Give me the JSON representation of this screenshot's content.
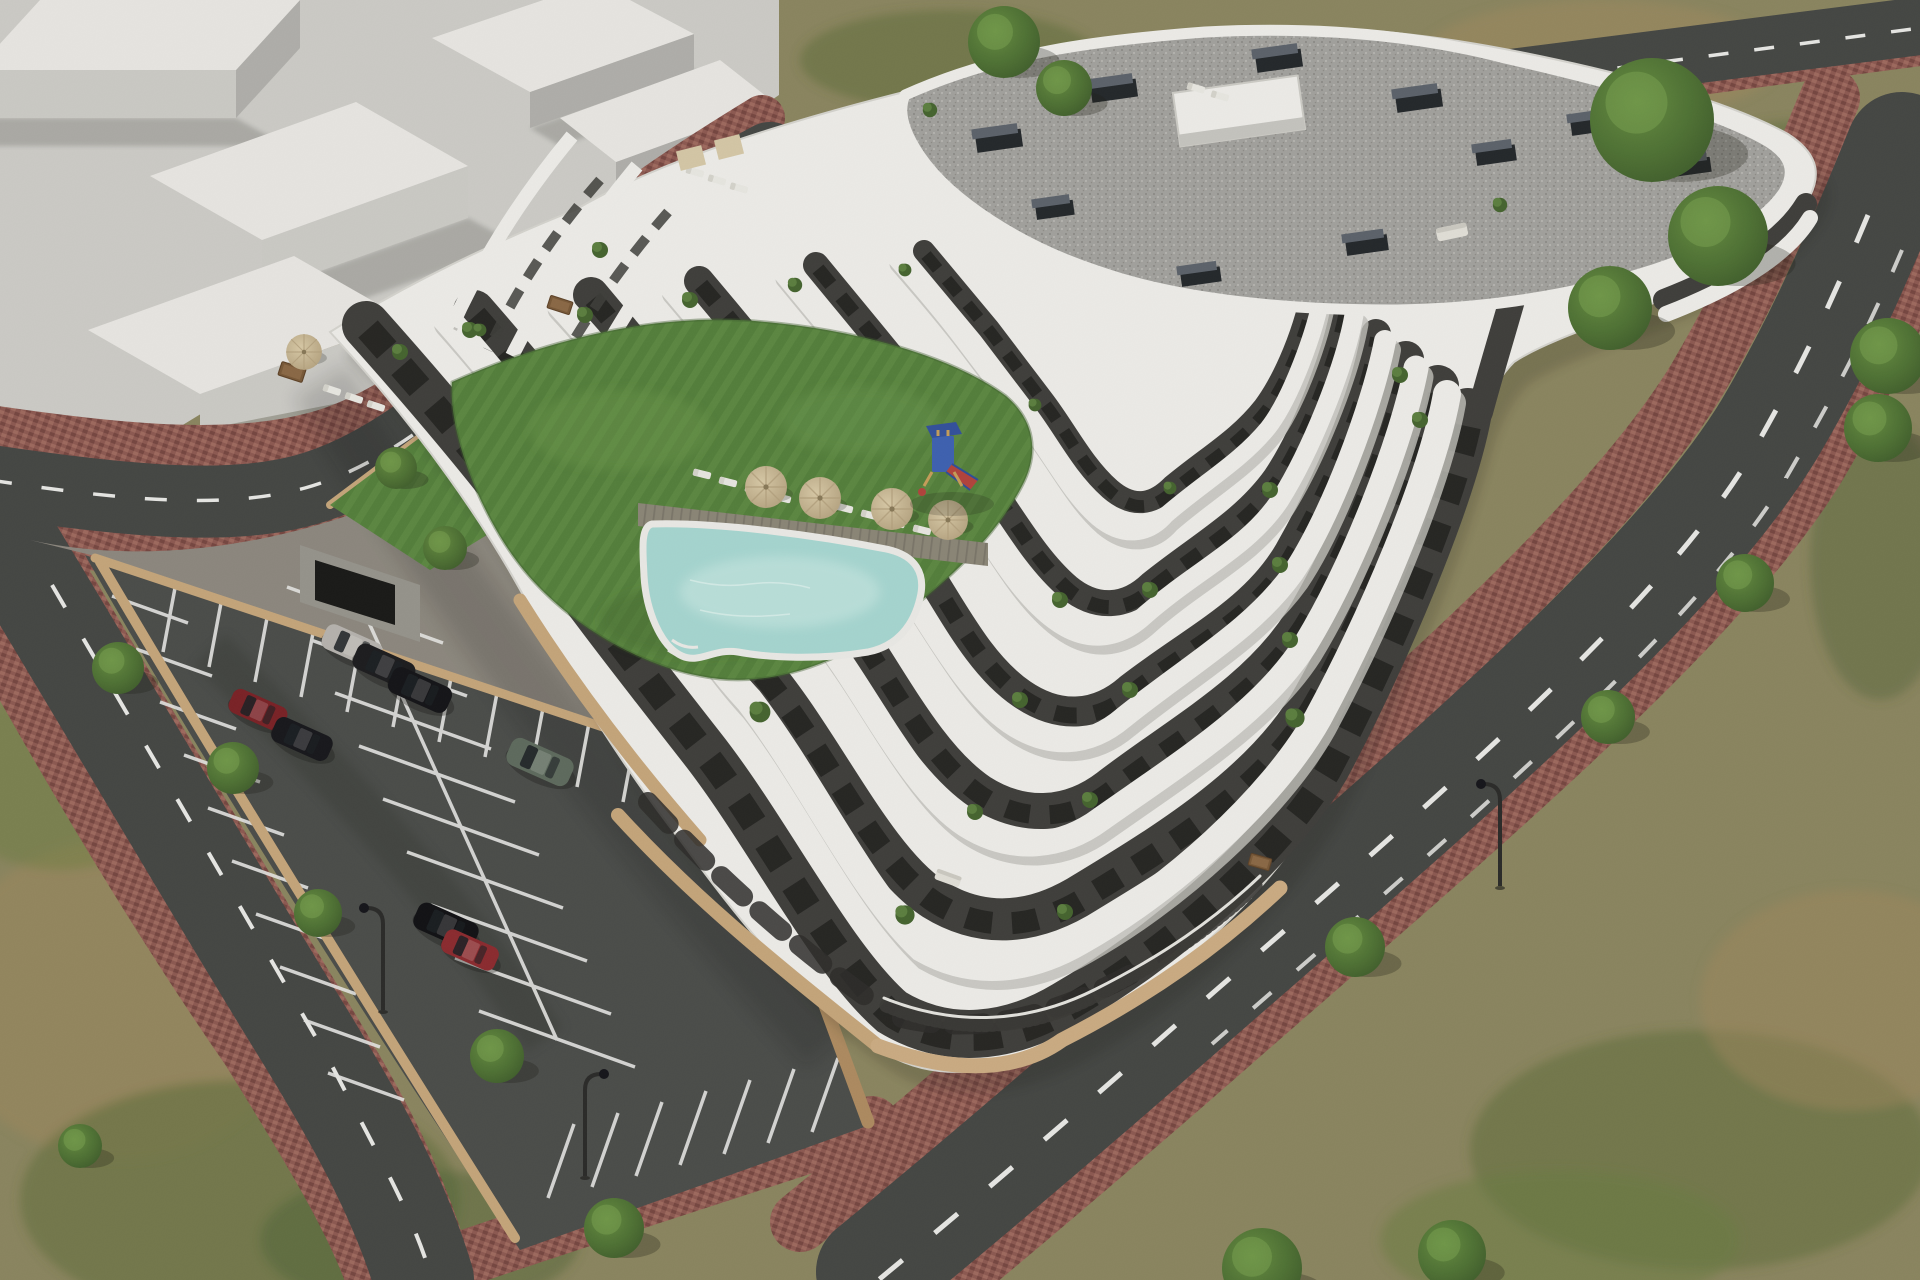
{
  "image": {
    "kind": "architectural-aerial-render",
    "subject": "modern terraced apartment complex with courtyard lawn, swimming pool, timber sun deck, children playground, roof terraces, surface parking lot and surrounding streets",
    "view": "aerial three-quarter view, daytime sun",
    "text_content": "none"
  },
  "palette": {
    "scrub_base": "#8d8760",
    "scrub_green": "#5c6e3a",
    "scrub_brown": "#a08a5e",
    "scrub_dark": "#4f6335",
    "massing_ground": "#d0cfca",
    "massing_block_top": "#eceae6",
    "massing_block_front": "#cfcec9",
    "massing_block_side": "#b3b2ad",
    "massing_shadow": "#a9a8a3",
    "road_asphalt": "#454744",
    "road_marking": "#ebebe8",
    "sidewalk_brick": "#8f5a52",
    "sidewalk_brick_dark": "#784741",
    "sidewalk_brick_light": "#a16b5f",
    "parking_asphalt": "#4b4d4a",
    "parking_marking": "#e9e9e6",
    "site_wall": "#c9a87c",
    "site_wall_dark": "#b08d61",
    "building_white": "#f2f1ed",
    "building_shadowline": "#c6c5bf",
    "facade_dark": "#403f3b",
    "window_dark": "#1f1f1d",
    "terrace_floor": "#e0ded7",
    "roof_gravel": "#a5a4a0",
    "roof_gravel_dot": "#8b8a85",
    "vent_dark": "#23272b",
    "vent_top": "#5d646c",
    "lawn_green": "#55813c",
    "lawn_light": "#6b984c",
    "pool_water": "#a9dad4",
    "pool_light": "#c6e9e3",
    "pool_coping": "#efeeea",
    "deck_wood": "#8d8878",
    "deck_wood_dark": "#7c776a",
    "umbrella_tan": "#dccda9",
    "umbrella_edge": "#b6a37f",
    "lounger_white": "#ecebe5",
    "tree_light": "#679040",
    "tree_dark": "#3f5e2b",
    "lamp_dark": "#2b2b29",
    "playground_blue": "#3e62b4",
    "playground_blue_dark": "#33519e",
    "playground_red": "#b5433c",
    "playground_wood": "#caa05a",
    "garage_opening": "#191917"
  },
  "site": {
    "building": {
      "floors_visible": 7,
      "roof_type": "flat gravel roof with vent stacks and stair bulkhead",
      "balcony_style": "organic curved white parapet bands with planted terraces",
      "vent_count": 10,
      "has_stair_bulkhead": true
    },
    "courtyard": {
      "features": [
        "lawn",
        "swimming pool",
        "timber sun deck",
        "sun umbrellas",
        "sun loungers",
        "children playground"
      ],
      "umbrella_count": 5,
      "lounger_count": 16
    },
    "parking": {
      "marked_rows": 4,
      "vehicles": [
        {
          "type": "sedan",
          "color": "#b9b6b0"
        },
        {
          "type": "sedan",
          "color": "#1c1c1e"
        },
        {
          "type": "sedan",
          "color": "#141417"
        },
        {
          "type": "hatchback",
          "color": "#7c2125"
        },
        {
          "type": "sedan",
          "color": "#17171b"
        },
        {
          "type": "suv",
          "color": "#5f6c5e"
        },
        {
          "type": "suv",
          "color": "#101013"
        },
        {
          "type": "compact",
          "color": "#8e2b2f"
        }
      ]
    },
    "streets": {
      "roads": 4,
      "lane_marking": "dashed white",
      "sidewalk": "red clay pavers",
      "street_tree_count": 20,
      "street_lamp_count": 3
    }
  }
}
